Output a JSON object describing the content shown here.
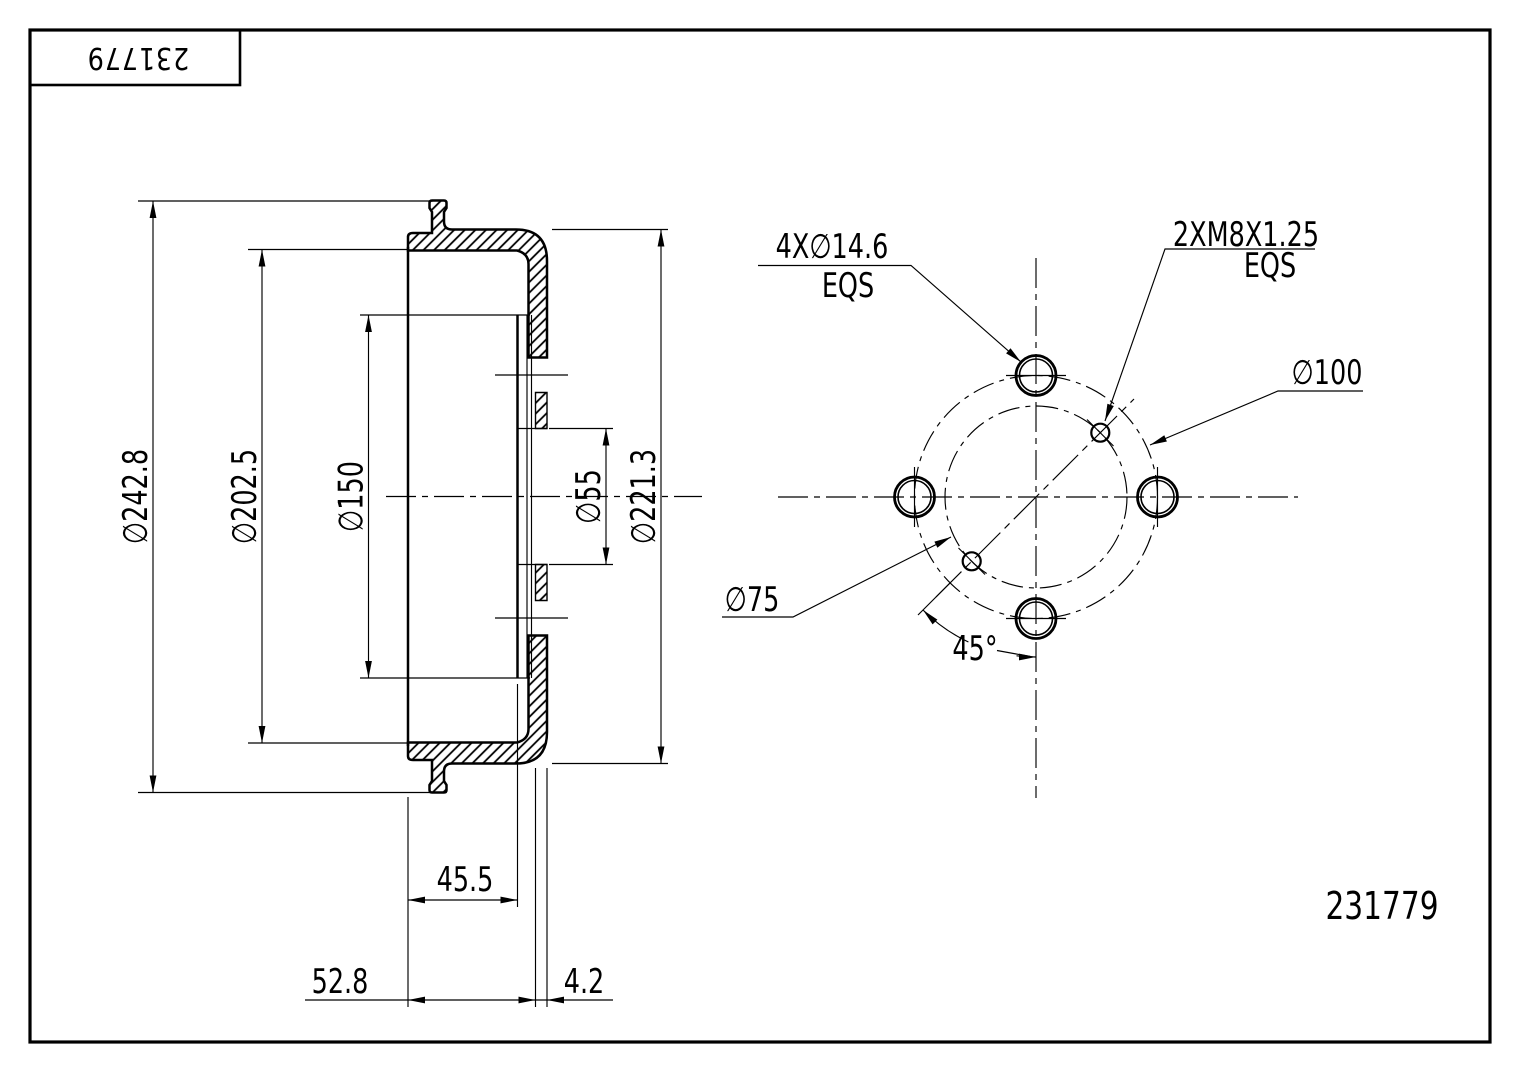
{
  "page": {
    "background": "#ffffff",
    "line_color": "#000000"
  },
  "title_block": {
    "part_number": "231779"
  },
  "footer": {
    "part_number": "231779"
  },
  "section_view": {
    "dims": {
      "d242": "∅242.8",
      "d202": "∅202.5",
      "d150": "∅150",
      "d55": "∅55",
      "d221": "∅221.3",
      "w455": "45.5",
      "w528": "52.8",
      "w42": "4.2"
    }
  },
  "front_view": {
    "bolt_holes": "4X∅14.6",
    "bolt_holes_eqs": "EQS",
    "thread": "2XM8X1.25",
    "thread_eqs": "EQS",
    "bolt_circle": "∅100",
    "thread_circle": "∅75",
    "angle": "45°"
  }
}
